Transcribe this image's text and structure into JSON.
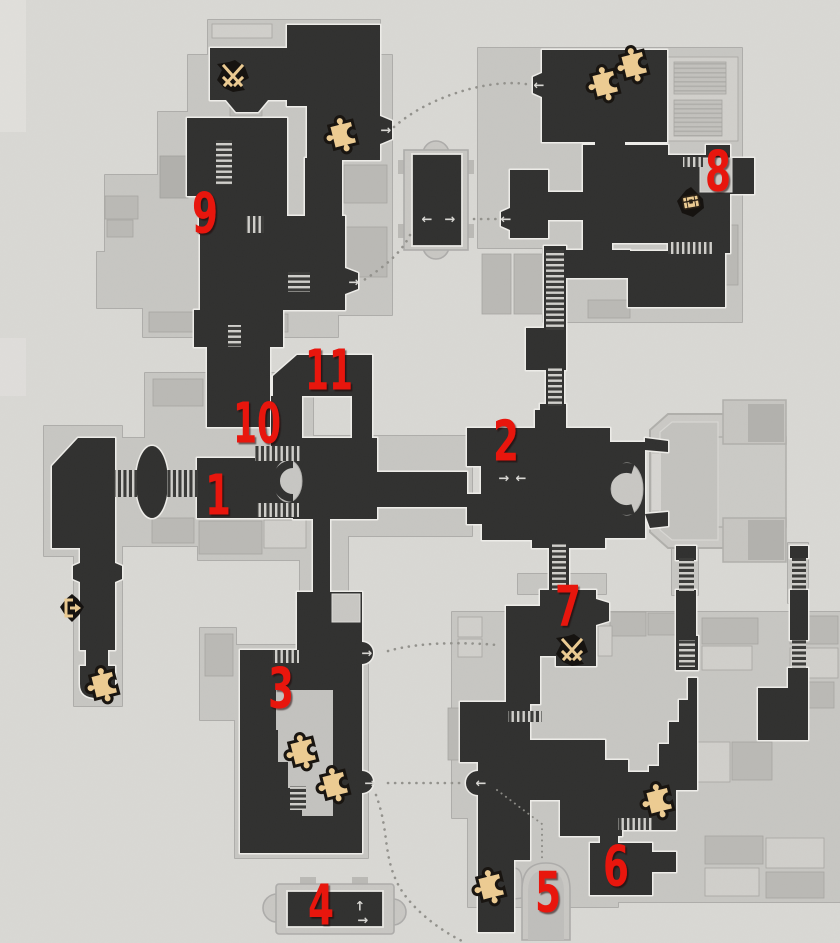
{
  "map": {
    "markers": [
      {
        "label": "1",
        "x": 218,
        "y": 496
      },
      {
        "label": "2",
        "x": 506,
        "y": 442
      },
      {
        "label": "3",
        "x": 281,
        "y": 689
      },
      {
        "label": "4",
        "x": 321,
        "y": 906
      },
      {
        "label": "5",
        "x": 548,
        "y": 893
      },
      {
        "label": "6",
        "x": 616,
        "y": 867
      },
      {
        "label": "7",
        "x": 568,
        "y": 607
      },
      {
        "label": "8",
        "x": 718,
        "y": 172
      },
      {
        "label": "9",
        "x": 205,
        "y": 214
      },
      {
        "label": "10",
        "x": 257,
        "y": 424
      },
      {
        "label": "11",
        "x": 329,
        "y": 371
      }
    ],
    "icons": [
      {
        "type": "space-anchor",
        "name": "space-anchor-icon",
        "x": 296,
        "y": 262
      },
      {
        "type": "space-anchor",
        "name": "space-anchor-icon",
        "x": 85,
        "y": 560
      },
      {
        "type": "space-anchor",
        "name": "space-anchor-icon",
        "x": 577,
        "y": 350
      },
      {
        "type": "space-anchor",
        "name": "space-anchor-icon",
        "x": 530,
        "y": 640
      },
      {
        "type": "enemy",
        "name": "crossed-swords-icon",
        "x": 233,
        "y": 76
      },
      {
        "type": "enemy",
        "name": "crossed-swords-icon",
        "x": 572,
        "y": 650
      },
      {
        "type": "chest",
        "name": "treasure-chest-icon",
        "x": 691,
        "y": 202
      },
      {
        "type": "exit",
        "name": "exit-door-icon",
        "x": 72,
        "y": 608
      },
      {
        "type": "puzzle",
        "name": "puzzle-piece-icon",
        "x": 342,
        "y": 134
      },
      {
        "type": "puzzle",
        "name": "puzzle-piece-icon",
        "x": 604,
        "y": 83
      },
      {
        "type": "puzzle",
        "name": "puzzle-piece-icon",
        "x": 633,
        "y": 64
      },
      {
        "type": "puzzle",
        "name": "puzzle-piece-icon",
        "x": 103,
        "y": 684
      },
      {
        "type": "puzzle",
        "name": "puzzle-piece-icon",
        "x": 302,
        "y": 751
      },
      {
        "type": "puzzle",
        "name": "puzzle-piece-icon",
        "x": 334,
        "y": 784
      },
      {
        "type": "puzzle",
        "name": "puzzle-piece-icon",
        "x": 658,
        "y": 800
      },
      {
        "type": "puzzle",
        "name": "puzzle-piece-icon",
        "x": 490,
        "y": 886
      }
    ],
    "transfer_arrows": [
      {
        "glyph": "→",
        "x": 386,
        "y": 131
      },
      {
        "glyph": "→",
        "x": 354,
        "y": 283
      },
      {
        "glyph": "←",
        "x": 539,
        "y": 86
      },
      {
        "glyph": "←",
        "x": 506,
        "y": 220
      },
      {
        "glyph": "→",
        "x": 504,
        "y": 479
      },
      {
        "glyph": "←",
        "x": 521,
        "y": 479
      },
      {
        "glyph": "←",
        "x": 427,
        "y": 220
      },
      {
        "glyph": "→",
        "x": 450,
        "y": 220
      },
      {
        "glyph": "→",
        "x": 367,
        "y": 654
      },
      {
        "glyph": "→",
        "x": 370,
        "y": 784
      },
      {
        "glyph": "←",
        "x": 481,
        "y": 784
      },
      {
        "glyph": "↑",
        "x": 360,
        "y": 907
      },
      {
        "glyph": "→",
        "x": 363,
        "y": 921
      }
    ],
    "colors": {
      "background": "#d9d8d4",
      "room_dark": "#30302f",
      "room_outline": "#eeede9",
      "underlay": "#c7c6c2",
      "marker_red": "#e8120b",
      "anchor_blue": "#2f9ff2",
      "icon_tan": "#eccb92",
      "icon_black": "#161310",
      "dotted_path": "#92918c"
    }
  }
}
